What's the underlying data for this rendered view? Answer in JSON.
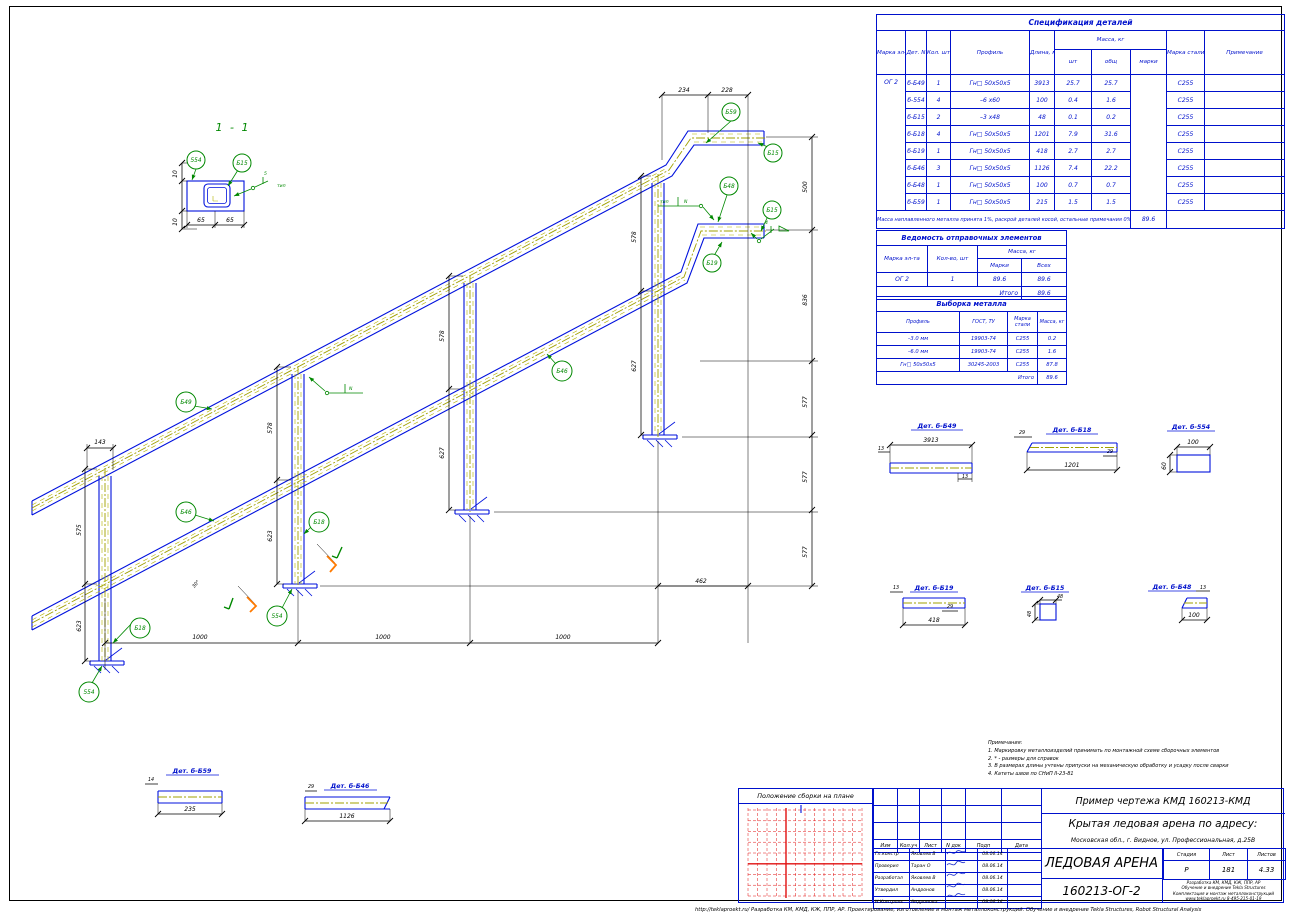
{
  "spec": {
    "title": "Спецификация деталей",
    "h": {
      "mark": "Марка эл-та",
      "det": "Дет. N",
      "qty": "Кол. шт",
      "profile": "Профиль",
      "len": "Длина, мм",
      "mass": "Масса, кг",
      "m1": "шт",
      "m2": "общ",
      "m3": "марки",
      "steel": "Марка стали",
      "note": "Примечание"
    },
    "rows": [
      {
        "mark": "ОГ 2",
        "det": "б-Б49",
        "qty": "1",
        "profile": "Гн□ 50х50х5",
        "len": "3913",
        "m1": "25.7",
        "m2": "25.7",
        "steel": "С255"
      },
      {
        "mark": "",
        "det": "б-554",
        "qty": "4",
        "profile": "–6 х60",
        "len": "100",
        "m1": "0.4",
        "m2": "1.6",
        "steel": "С255"
      },
      {
        "mark": "",
        "det": "б-Б15",
        "qty": "2",
        "profile": "–3 х48",
        "len": "48",
        "m1": "0.1",
        "m2": "0.2",
        "steel": "С255"
      },
      {
        "mark": "",
        "det": "б-Б18",
        "qty": "4",
        "profile": "Гн□ 50х50х5",
        "len": "1201",
        "m1": "7.9",
        "m2": "31.6",
        "steel": "С255"
      },
      {
        "mark": "",
        "det": "б-Б19",
        "qty": "1",
        "profile": "Гн□ 50х50х5",
        "len": "418",
        "m1": "2.7",
        "m2": "2.7",
        "steel": "С255"
      },
      {
        "mark": "",
        "det": "б-Б46",
        "qty": "3",
        "profile": "Гн□ 50х50х5",
        "len": "1126",
        "m1": "7.4",
        "m2": "22.2",
        "steel": "С255"
      },
      {
        "mark": "",
        "det": "б-Б48",
        "qty": "1",
        "profile": "Гн□ 50х50х5",
        "len": "100",
        "m1": "0.7",
        "m2": "0.7",
        "steel": "С255"
      },
      {
        "mark": "",
        "det": "б-Б59",
        "qty": "1",
        "profile": "Гн□ 50х50х5",
        "len": "215",
        "m1": "1.5",
        "m2": "1.5",
        "steel": "С255"
      }
    ],
    "note": "Масса наплавленного металла принята 1%, раскрой деталей косой, остальные примечания 0% - 16 кг",
    "total": "89.6"
  },
  "shipping": {
    "title": "Ведомость отправочных элементов",
    "h": {
      "mark": "Марка эл-та",
      "qty": "Кол-во, шт",
      "mass": "Масса, кг",
      "m1": "Марки",
      "m2": "Всех"
    },
    "row": {
      "mark": "ОГ 2",
      "qty": "1",
      "m1": "89.6",
      "m2": "89.6"
    },
    "total_label": "Итого",
    "total": "89.6"
  },
  "metal": {
    "title": "Выборка металла",
    "h": {
      "profile": "Профиль",
      "gost": "ГОСТ, ТУ",
      "steel": "Марка стали",
      "mass": "Масса, кг"
    },
    "rows": [
      {
        "profile": "–3.0 мм",
        "gost": "19903-74",
        "steel": "С255",
        "mass": "0.2"
      },
      {
        "profile": "–6.0 мм",
        "gost": "19903-74",
        "steel": "С255",
        "mass": "1.6"
      },
      {
        "profile": "Гн□ 50х50х5",
        "gost": "30245-2003",
        "steel": "С255",
        "mass": "87.8"
      }
    ],
    "total_label": "Итого",
    "total": "89.6"
  },
  "section": {
    "title": "1 - 1",
    "balloon1": "554",
    "balloon2": "Б15",
    "d1": "10",
    "d2": "10",
    "d3": "65",
    "d4": "65",
    "weld_size": "5",
    "weld_note": "тип"
  },
  "iso": {
    "balloons": [
      "Б59",
      "Б15",
      "Б48",
      "Б15",
      "Б19",
      "Б49",
      "Б46",
      "Б18",
      "Б18",
      "554",
      "554",
      "Б46"
    ],
    "dims": {
      "top1": "234",
      "top2": "228",
      "r1": "500",
      "r2": "836",
      "r3": "577",
      "r4": "577",
      "r5": "577",
      "b1": "1000",
      "b2": "1000",
      "b3": "1000",
      "b4": "462",
      "l0": "143",
      "p1a": "575",
      "p1b": "623",
      "p2a": "578",
      "p2b": "623",
      "p3a": "578",
      "p3b": "627",
      "p4a": "578",
      "p4b": "627",
      "ang": "30°"
    },
    "weld1": {
      "t": "тип",
      "n": "N"
    },
    "weld2": {
      "t": "4"
    },
    "weld3": {
      "n": "N"
    }
  },
  "details": {
    "d49": {
      "title": "Дет. б-Б49",
      "dim": "3913",
      "s1": "13",
      "s2": "13"
    },
    "d18": {
      "title": "Дет. б-Б18",
      "dim": "1201",
      "s1": "29",
      "s2": "29"
    },
    "d554": {
      "title": "Дет. б-554",
      "dim": "100",
      "s1": "60"
    },
    "d19": {
      "title": "Дет. б-Б19",
      "dim": "418",
      "s1": "13",
      "s2": "29"
    },
    "d15": {
      "title": "Дет. б-Б15",
      "dim": "48",
      "s1": "48"
    },
    "d48": {
      "title": "Дет. б-Б48",
      "dim": "100",
      "s1": "13"
    },
    "d59": {
      "title": "Дет. б-Б59",
      "dim": "235",
      "s1": "14"
    },
    "d46": {
      "title": "Дет. б-Б46",
      "dim": "1126",
      "s1": "29"
    }
  },
  "notes": {
    "title": "Примечания:",
    "items": [
      "1. Маркировку металлоизделий принимать по монтажной схеме сборочных элементов",
      "2. * - размеры для справок",
      "3. В размерах длины учтены припуски на механическую обработку и усадку после сварки",
      "4. Катеты швов по СНиП II-23-81"
    ]
  },
  "titleblock": {
    "top": "Пример чертежа КМД  160213-КМД",
    "object": "Крытая ледовая арена по адресу:",
    "address": "Московская обл., г. Видное, ул. Профессиональная, д.25В",
    "name": "ЛЕДОВАЯ АРЕНА",
    "doc": "160213-ОГ-2",
    "stage_h": "Стадия",
    "sheet_h": "Лист",
    "sheets_h": "Листов",
    "stage": "Р",
    "sheet": "181",
    "sheets": "4.33",
    "company": [
      "Разработка КМ, КМД, КЖ, ППР, АР",
      "Обучение и внедрение Tekla Structures",
      "Комплектация и монтаж металлоконструкций",
      "www.teklaproekt.ru    8-495-215-01-19"
    ],
    "plan_label": "Положение сборки на плане",
    "rev": [
      "Изм",
      "Кол.уч",
      "Лист",
      "N док",
      "Подп",
      "Дата"
    ],
    "signs": [
      {
        "role": "Гл.констр",
        "name": "Яковлев В",
        "date": "08.06.14"
      },
      {
        "role": "Проверил",
        "name": "Таран О",
        "date": "08.06.14"
      },
      {
        "role": "Разработал",
        "name": "Яковлев В",
        "date": "08.06.14"
      },
      {
        "role": "Утвердил",
        "name": "Андронов",
        "date": "08.06.14"
      },
      {
        "role": "Н.Контроль",
        "name": "Андронова",
        "date": "08.06.14"
      }
    ]
  },
  "footer": "http://teklaproekt.ru/   Разработка КМ, КМД, КЖ, ППР, АР. Проектирование, изготовление и монтаж металлоконструкций. Обучение и внедрение Tekla Structures, Robot Structural Analysis"
}
